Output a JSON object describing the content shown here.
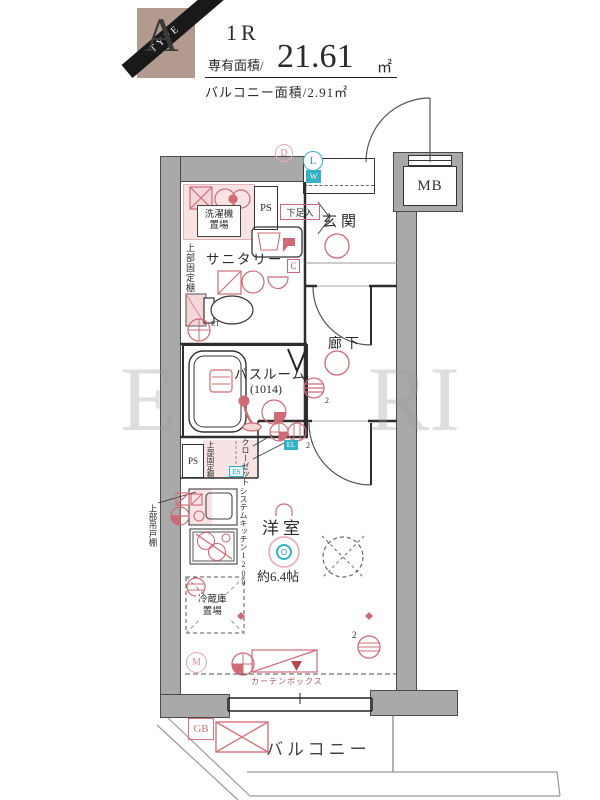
{
  "header": {
    "type_letter": "A",
    "type_word": "TYPE",
    "layout_type": "1R",
    "area_label": "専有面積/",
    "area_value": "21.61",
    "area_unit": "㎡",
    "balcony_area_text": "バルコニー面積/2.91㎡"
  },
  "watermark": {
    "left": "E",
    "right": "RI"
  },
  "labels": {
    "genkan": "玄関",
    "corridor": "廊下",
    "bathroom": "バスルーム",
    "bathroom_size": "(1014)",
    "sanitary": "サニタリー",
    "washer_line1": "洗濯機",
    "washer_line2": "置場",
    "upper_fixed_shelf_1": "上部固定棚",
    "upper_fixed_shelf_2": "上部固定棚",
    "upper_hanging_cupboard": "上部吊戸棚",
    "shoe_box": "下足入",
    "closet": "クローゼット",
    "system_kitchen": "システムキッチン1200",
    "fridge_line1": "冷蔵庫",
    "fridge_line2": "置場",
    "western_room": "洋室",
    "western_room_size": "約6.4帖",
    "curtain_box": "カーテンボックス",
    "balcony": "バルコニー"
  },
  "badges": {
    "mb": "MB",
    "ps_top": "PS",
    "ps_side": "PS",
    "d": "D",
    "l": "L",
    "w": "W",
    "c": "C",
    "es": "ES",
    "el": "EL",
    "et": "ET",
    "m": "M",
    "gb": "GB",
    "num2_corridor": "2",
    "num2_closet": "2",
    "num2_room": "2"
  },
  "colors": {
    "accent_pink": "#cf6b76",
    "accent_pink_fill": "#f7e3e4",
    "accent_teal": "#35b0c4",
    "wall_gray": "#a9a9a9",
    "badge_tan": "#b29a8f",
    "ribbon_black": "#191919"
  }
}
